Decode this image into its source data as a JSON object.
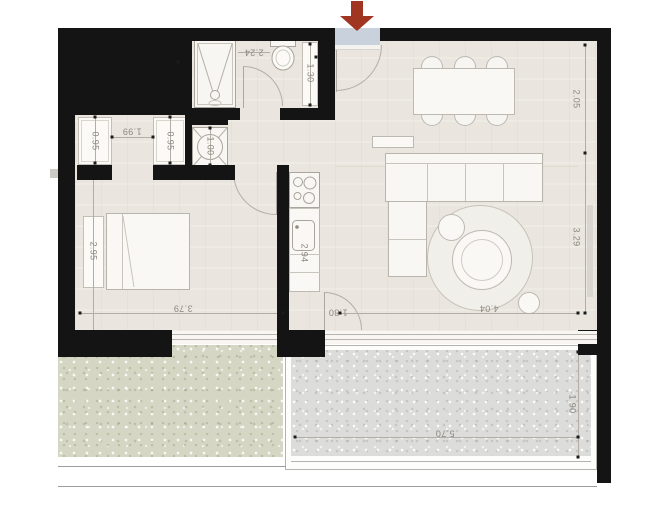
{
  "plan_title": "apartment-floor-plan",
  "dims": {
    "bath_width": "2.24",
    "bath_depth": "1.30",
    "niche_left": "0.95",
    "niche_opening": "1.99",
    "niche_right": "0.95",
    "laundry_width": "1.00",
    "bedroom_depth": "2.95",
    "bedroom_width": "3.79",
    "kitchen_run": "2.94",
    "terrace_door": "1.80",
    "living_right_upper": "2.05",
    "living_right_lower": "3.29",
    "living_width": "4.04",
    "terrace_width": "5.70",
    "terrace_depth": "1.90"
  },
  "colors": {
    "wall": "#141414",
    "floor": "#eae5de",
    "grass": "#d5d7c4",
    "terrace": "#dcdcda",
    "entrance_marker": "#c9d2dc",
    "arrow": "#a03522"
  }
}
